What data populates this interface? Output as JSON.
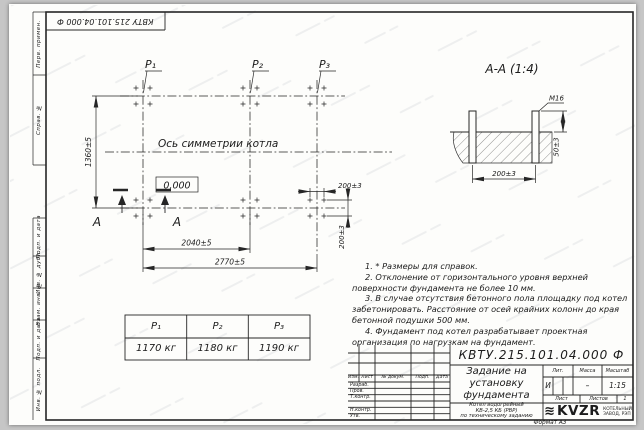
{
  "colors": {
    "background": "#c6c6c6",
    "sheet": "#fdfdfb",
    "line": "#262626"
  },
  "frame": {
    "corner_stamp": "КВТУ 215.101.04.000 Ф",
    "format_note": "Формат А3",
    "side_labels": {
      "perv_primen": "Перв. примен.",
      "sprav_no": "Справ. №",
      "podp_data_top": "Подп. и дата",
      "inv_dubl": "Инв. № дубл.",
      "vzam_inv": "Взам. инв. №",
      "podp_data_bottom": "Подп. и дата",
      "inv_podl": "Инв. № подл."
    }
  },
  "plan": {
    "load_labels": {
      "p1": "Р₁",
      "p2": "Р₂",
      "p3": "Р₃"
    },
    "axis_label": "Ось симметрии котла",
    "elevation_mark": "0,000",
    "dim_height": "1360±5",
    "dim_span_p1_p2": "2040±5",
    "dim_span_total": "2770±5",
    "dim_bolt_spacing_x": "200±3",
    "dim_bolt_spacing_y": "200±3",
    "section_letter_left": "А",
    "section_letter_right": "А"
  },
  "section_view": {
    "title": "А-А (1:4)",
    "thread_callout": "М16",
    "dim_protrusion": "50±3",
    "dim_bolt_spacing": "200±3"
  },
  "notes": {
    "items": [
      "1. * Размеры для справок.",
      "2. Отклонение от горизонтального уровня верхней поверхности фундамента не более 10 мм.",
      "3. В случае отсутствия бетонного пола площадку под котел забетонировать. Расстояние от осей крайних колонн до края бетонной подушки 500 мм.",
      "4. Фундамент под котел разрабатывает проектная организация по нагрузкам на фундамент."
    ]
  },
  "load_table": {
    "headers": [
      "Р₁",
      "Р₂",
      "Р₃"
    ],
    "values": [
      "1170 кг",
      "1180 кг",
      "1190 кг"
    ]
  },
  "title_block": {
    "designation": "КВТУ.215.101.04.000 Ф",
    "title_lines": [
      "Задание на",
      "установку",
      "фундамента"
    ],
    "columns": {
      "izm": "Изм.",
      "list": "Лист",
      "doc": "№ докум.",
      "podp": "Подп.",
      "data": "Дата"
    },
    "signature_rows": [
      "Разраб.",
      "Пров.",
      "Т.контр.",
      "",
      "Н.контр.",
      "Утв."
    ],
    "lit_header": "Лит.",
    "mass_header": "Масса",
    "scale_header": "Масштаб",
    "lit_value": "И",
    "mass_value": "–",
    "scale_value": "1:15",
    "sheet_label": "Лист",
    "sheets_label": "Листов",
    "sheets_value": "1",
    "product_lines": [
      "Котел водогрейный",
      "КВ-2,5 КБ (РВР)",
      "по техническому заданию"
    ],
    "logo_text": "KVZR",
    "logo_caption_lines": [
      "КОТЕЛЬНЫЙ",
      "ЗАВОД, РЭП"
    ]
  }
}
